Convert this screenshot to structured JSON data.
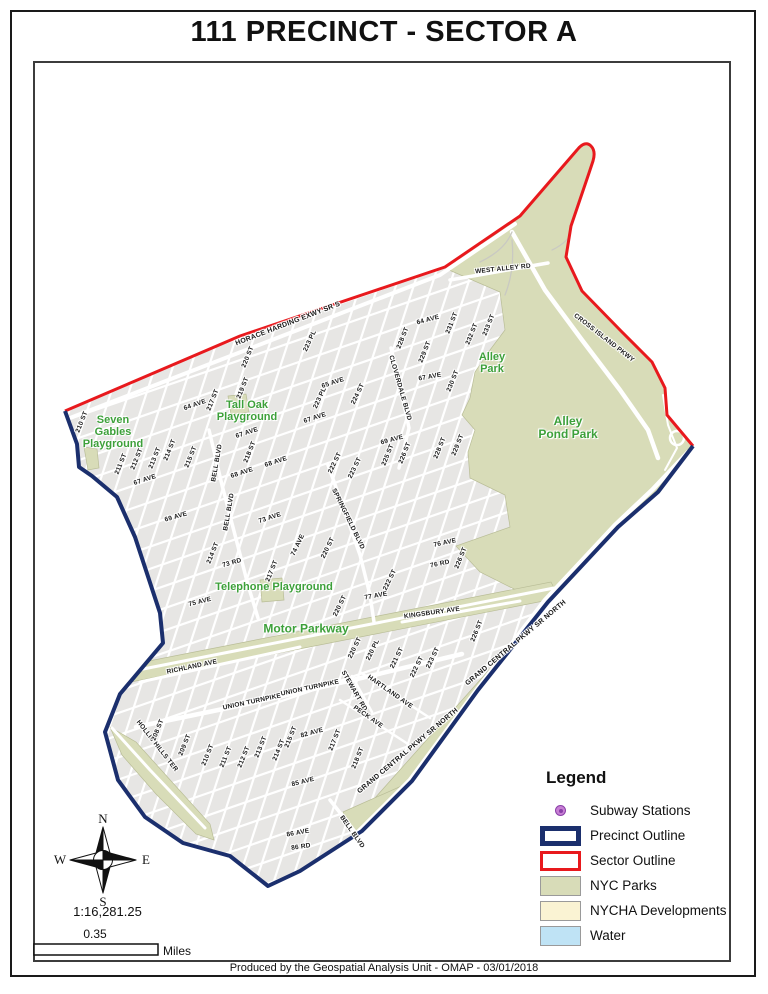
{
  "title": "111 PRECINCT - SECTOR A",
  "footer": "Produced by the Geospatial Analysis Unit - OMAP - 03/01/2018",
  "compass": {
    "n": "N",
    "s": "S",
    "e": "E",
    "w": "W"
  },
  "scale": {
    "ratio": "1:16,281.25",
    "distance": "0.35",
    "unit": "Miles"
  },
  "colors": {
    "precinct_outline": "#1b2f6d",
    "sector_outline": "#e8191d",
    "nyc_parks": "#d8dcb8",
    "nycha_developments": "#faf3d3",
    "water": "#bfe3f5",
    "subway_fill": "#c77fd4",
    "subway_ring": "#8a3fa8",
    "park_label": "#3da03a",
    "urban_fill": "#e7e6e4"
  },
  "legend": {
    "title": "Legend",
    "items": [
      {
        "label": "Subway Stations",
        "swatch": "subway"
      },
      {
        "label": "Precinct Outline",
        "swatch": "precinct"
      },
      {
        "label": "Sector Outline",
        "swatch": "sector"
      },
      {
        "label": "NYC Parks",
        "swatch": "parks"
      },
      {
        "label": "NYCHA Developments",
        "swatch": "nycha"
      },
      {
        "label": "Water",
        "swatch": "water"
      }
    ]
  },
  "map": {
    "park_labels": [
      {
        "t": "Seven\nGables\nPlayground",
        "x": 113,
        "y": 433,
        "s": 11
      },
      {
        "t": "Tall Oak\nPlayground",
        "x": 247,
        "y": 412,
        "s": 11
      },
      {
        "t": "Alley\nPark",
        "x": 492,
        "y": 364,
        "s": 11
      },
      {
        "t": "Alley\nPond Park",
        "x": 568,
        "y": 428,
        "s": 12
      },
      {
        "t": "Telephone Playground",
        "x": 274,
        "y": 588,
        "s": 11
      },
      {
        "t": "Motor Parkway",
        "x": 306,
        "y": 629,
        "s": 12
      }
    ],
    "street_labels": [
      {
        "t": "HORACE HARDING EXWY SR S",
        "x": 288,
        "y": 324,
        "r": -21,
        "s": 7
      },
      {
        "t": "WEST ALLEY RD",
        "x": 503,
        "y": 269,
        "r": -6
      },
      {
        "t": "CROSS ISLAND PKWY",
        "x": 604,
        "y": 338,
        "r": 38
      },
      {
        "t": "223 PL",
        "x": 310,
        "y": 341,
        "r": -65
      },
      {
        "t": "220 ST",
        "x": 248,
        "y": 357,
        "r": -68
      },
      {
        "t": "219 ST",
        "x": 243,
        "y": 388,
        "r": -68
      },
      {
        "t": "217 ST",
        "x": 213,
        "y": 400,
        "r": -68
      },
      {
        "t": "64 AVE",
        "x": 195,
        "y": 405,
        "r": -19
      },
      {
        "t": "210 ST",
        "x": 82,
        "y": 422,
        "r": -68
      },
      {
        "t": "65 AVE",
        "x": 333,
        "y": 383,
        "r": -18
      },
      {
        "t": "223 PL",
        "x": 320,
        "y": 398,
        "r": -65
      },
      {
        "t": "67 AVE",
        "x": 315,
        "y": 418,
        "r": -18
      },
      {
        "t": "67 AVE",
        "x": 247,
        "y": 433,
        "r": -18
      },
      {
        "t": "67 AVE",
        "x": 145,
        "y": 480,
        "r": -18
      },
      {
        "t": "211 ST",
        "x": 121,
        "y": 464,
        "r": -68
      },
      {
        "t": "212 ST",
        "x": 137,
        "y": 459,
        "r": -68
      },
      {
        "t": "213 ST",
        "x": 155,
        "y": 458,
        "r": -68
      },
      {
        "t": "214 ST",
        "x": 170,
        "y": 450,
        "r": -68
      },
      {
        "t": "215 ST",
        "x": 191,
        "y": 457,
        "r": -68
      },
      {
        "t": "218 ST",
        "x": 250,
        "y": 452,
        "r": -68
      },
      {
        "t": "BELL BLVD",
        "x": 217,
        "y": 463,
        "r": -80
      },
      {
        "t": "BELL BLVD",
        "x": 229,
        "y": 512,
        "r": -80
      },
      {
        "t": "68 AVE",
        "x": 242,
        "y": 473,
        "r": -18
      },
      {
        "t": "68 AVE",
        "x": 276,
        "y": 462,
        "r": -18
      },
      {
        "t": "69 AVE",
        "x": 176,
        "y": 517,
        "r": -16
      },
      {
        "t": "73 AVE",
        "x": 270,
        "y": 518,
        "r": -18
      },
      {
        "t": "SPRINGFIELD BLVD",
        "x": 348,
        "y": 519,
        "r": 64
      },
      {
        "t": "214 ST",
        "x": 213,
        "y": 553,
        "r": -68
      },
      {
        "t": "73 RD",
        "x": 232,
        "y": 563,
        "r": -16
      },
      {
        "t": "217 ST",
        "x": 272,
        "y": 571,
        "r": -68
      },
      {
        "t": "74 AVE",
        "x": 298,
        "y": 545,
        "r": -64
      },
      {
        "t": "220 ST",
        "x": 328,
        "y": 548,
        "r": -64
      },
      {
        "t": "75 AVE",
        "x": 200,
        "y": 602,
        "r": -14
      },
      {
        "t": "77 AVE",
        "x": 376,
        "y": 596,
        "r": -10
      },
      {
        "t": "220 ST",
        "x": 340,
        "y": 606,
        "r": -64
      },
      {
        "t": "222 ST",
        "x": 390,
        "y": 580,
        "r": -64
      },
      {
        "t": "76 AVE",
        "x": 445,
        "y": 543,
        "r": -12
      },
      {
        "t": "226 ST",
        "x": 461,
        "y": 558,
        "r": -68
      },
      {
        "t": "76 RD",
        "x": 440,
        "y": 564,
        "r": -12
      },
      {
        "t": "64 AVE",
        "x": 428,
        "y": 320,
        "r": -15
      },
      {
        "t": "231 ST",
        "x": 452,
        "y": 323,
        "r": -68
      },
      {
        "t": "232 ST",
        "x": 472,
        "y": 334,
        "r": -68
      },
      {
        "t": "233 ST",
        "x": 489,
        "y": 325,
        "r": -68
      },
      {
        "t": "228 ST",
        "x": 403,
        "y": 338,
        "r": -68
      },
      {
        "t": "229 ST",
        "x": 425,
        "y": 352,
        "r": -68
      },
      {
        "t": "CLOVERDALE BLVD",
        "x": 400,
        "y": 388,
        "r": 74
      },
      {
        "t": "67 AVE",
        "x": 430,
        "y": 377,
        "r": -10
      },
      {
        "t": "230 ST",
        "x": 453,
        "y": 381,
        "r": -68
      },
      {
        "t": "224 ST",
        "x": 358,
        "y": 394,
        "r": -64
      },
      {
        "t": "69 AVE",
        "x": 392,
        "y": 440,
        "r": -15
      },
      {
        "t": "225 ST",
        "x": 388,
        "y": 455,
        "r": -68
      },
      {
        "t": "226 ST",
        "x": 405,
        "y": 453,
        "r": -68
      },
      {
        "t": "228 ST",
        "x": 440,
        "y": 448,
        "r": -68
      },
      {
        "t": "229 ST",
        "x": 458,
        "y": 445,
        "r": -68
      },
      {
        "t": "222 ST",
        "x": 335,
        "y": 463,
        "r": -64
      },
      {
        "t": "223 ST",
        "x": 355,
        "y": 468,
        "r": -64
      },
      {
        "t": "KINGSBURY AVE",
        "x": 432,
        "y": 613,
        "r": -8
      },
      {
        "t": "226 ST",
        "x": 477,
        "y": 631,
        "r": -68
      },
      {
        "t": "220 ST",
        "x": 355,
        "y": 648,
        "r": -64
      },
      {
        "t": "220 PL",
        "x": 373,
        "y": 650,
        "r": -64
      },
      {
        "t": "221 ST",
        "x": 397,
        "y": 658,
        "r": -64
      },
      {
        "t": "222 ST",
        "x": 417,
        "y": 667,
        "r": -64
      },
      {
        "t": "223 ST",
        "x": 433,
        "y": 658,
        "r": -64
      },
      {
        "t": "HARTLAND AVE",
        "x": 390,
        "y": 692,
        "r": 35
      },
      {
        "t": "STEWART RD",
        "x": 354,
        "y": 691,
        "r": 60
      },
      {
        "t": "PECK AVE",
        "x": 368,
        "y": 717,
        "r": 35
      },
      {
        "t": "GRAND CENTRAL PKWY SR NORTH",
        "x": 516,
        "y": 643,
        "r": -40,
        "s": 7
      },
      {
        "t": "GRAND CENTRAL PKWY SR NORTH",
        "x": 408,
        "y": 751,
        "r": -40,
        "s": 7
      },
      {
        "t": "217 ST",
        "x": 335,
        "y": 740,
        "r": -68
      },
      {
        "t": "218 ST",
        "x": 358,
        "y": 758,
        "r": -68
      },
      {
        "t": "RICHLAND AVE",
        "x": 192,
        "y": 667,
        "r": -12
      },
      {
        "t": "UNION TURNPIKE",
        "x": 252,
        "y": 702,
        "r": -12
      },
      {
        "t": "UNION TURNPIKE",
        "x": 310,
        "y": 688,
        "r": -12
      },
      {
        "t": "HOLLIS HILLS TER",
        "x": 157,
        "y": 746,
        "r": 52
      },
      {
        "t": "208 ST",
        "x": 158,
        "y": 730,
        "r": -68
      },
      {
        "t": "209 ST",
        "x": 185,
        "y": 745,
        "r": -68
      },
      {
        "t": "210 ST",
        "x": 208,
        "y": 755,
        "r": -68
      },
      {
        "t": "211 ST",
        "x": 226,
        "y": 757,
        "r": -68
      },
      {
        "t": "212 ST",
        "x": 244,
        "y": 757,
        "r": -68
      },
      {
        "t": "213 ST",
        "x": 261,
        "y": 747,
        "r": -68
      },
      {
        "t": "214 ST",
        "x": 279,
        "y": 750,
        "r": -68
      },
      {
        "t": "215 ST",
        "x": 291,
        "y": 737,
        "r": -68
      },
      {
        "t": "82 AVE",
        "x": 312,
        "y": 733,
        "r": -15
      },
      {
        "t": "85 AVE",
        "x": 303,
        "y": 782,
        "r": -14
      },
      {
        "t": "86 AVE",
        "x": 298,
        "y": 833,
        "r": -10
      },
      {
        "t": "86 RD",
        "x": 301,
        "y": 847,
        "r": -8
      },
      {
        "t": "BELL BLVD",
        "x": 352,
        "y": 832,
        "r": 55
      }
    ]
  }
}
